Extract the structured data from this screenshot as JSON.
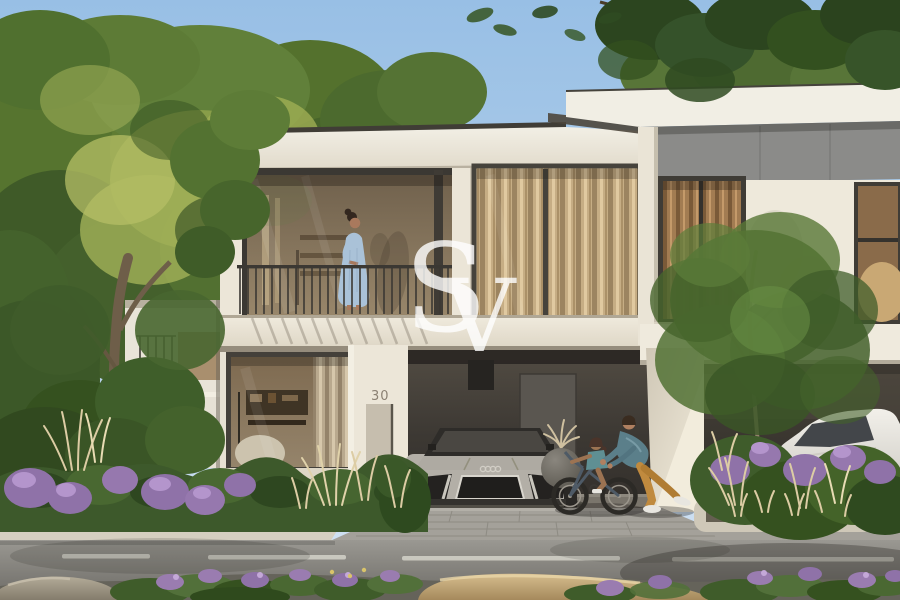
{
  "meta": {
    "type": "architectural-exterior-render",
    "subject": "Modern two-storey townhouse with carport, landscaping, residents and parked cars",
    "width_px": 900,
    "height_px": 600
  },
  "watermark": {
    "text": "SV",
    "letter_s": "S",
    "letter_v": "V",
    "color": "#ffffff"
  },
  "villa": {
    "house_number": "30",
    "storeys": 2,
    "features": [
      "balcony with dark railing",
      "floor-to-ceiling glazing",
      "beige curtains",
      "dark carport recess",
      "flat roof with white fascia"
    ]
  },
  "people": [
    {
      "id": "woman-on-balcony",
      "dress_color": "#aac2d8",
      "hair_color": "#33271f"
    },
    {
      "id": "man-pushing-bicycle",
      "shirt_color": "#5b7f8a",
      "trousers_color": "#c08a3e",
      "shoes_color": "#e8e6e0"
    },
    {
      "id": "child-on-bicycle",
      "shirt_color": "#5f8f93",
      "skin_color": "#9c7352"
    }
  ],
  "vehicles": [
    {
      "id": "silver-sports-car",
      "body_color": "#b3afa7",
      "glass_color": "#2e2c29",
      "location": "main carport"
    },
    {
      "id": "white-suv",
      "body_color": "#e9e7e1",
      "glass_color": "#43464a",
      "location": "neighbour carport"
    }
  ],
  "landscape": {
    "sky_top": "#98bfe5",
    "sky_horizon": "#d7e5f3",
    "tree_green_dark": "#2c451f",
    "tree_green_mid": "#54712f",
    "tree_green_light": "#a7b35d",
    "hedge_green": "#3d592b",
    "flower_purple": "#8f72a8",
    "flower_purple_light": "#b495cc",
    "grass_plume_beige": "#dccca4",
    "rock_tan": "#c2a878",
    "rock_grey": "#a89f8c",
    "trunk_brown": "#6e5e49"
  },
  "hardscape": {
    "wall_white_lit": "#f1ede3",
    "wall_white_shade": "#d9d3c7",
    "panel_grey": "#8b8b89",
    "carport_dark": "#3c3833",
    "garage_door_grey": "#5a5650",
    "driveway_paver": "#a4a19a",
    "street_asphalt": "#8f8d87",
    "curb_light": "#d5cfc0",
    "lane_marking": "#d4d2c9"
  }
}
